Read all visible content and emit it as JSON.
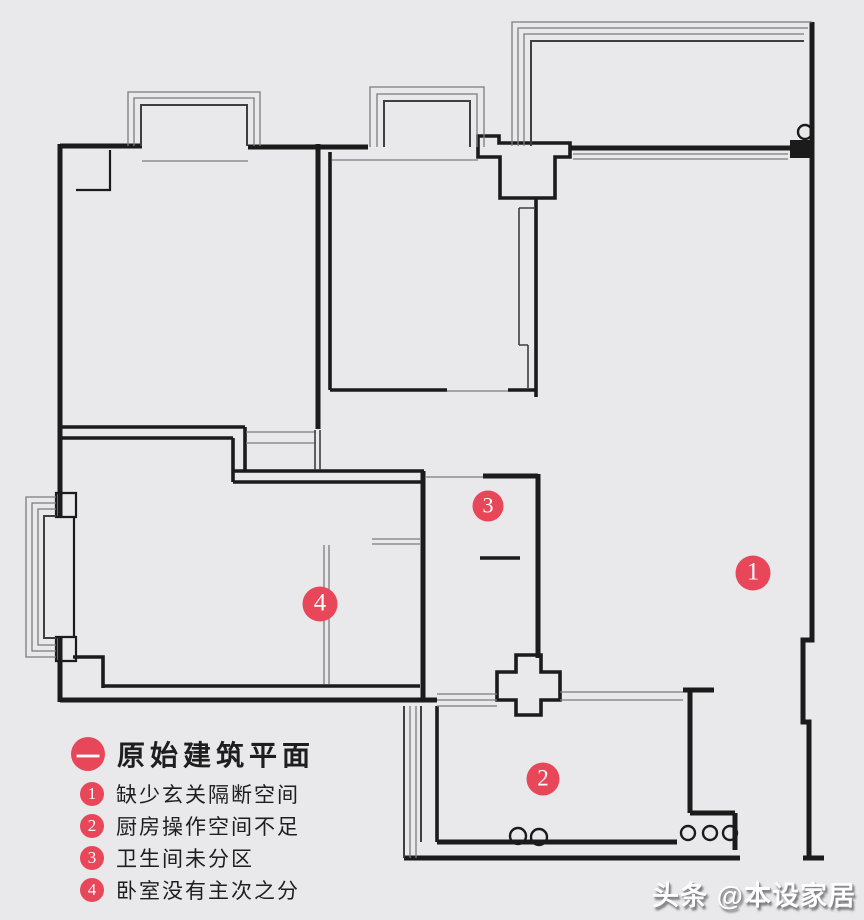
{
  "colors": {
    "background": "#e9e9eb",
    "wall": "#1b1b1b",
    "thin_line": "#7c7c7c",
    "accent_red": "#e8475a",
    "text": "#1e1e1e"
  },
  "legend": {
    "title_marker": "一",
    "title": "原始建筑平面",
    "items": [
      {
        "num": "1",
        "text": "缺少玄关隔断空间"
      },
      {
        "num": "2",
        "text": "厨房操作空间不足"
      },
      {
        "num": "3",
        "text": "卫生间未分区"
      },
      {
        "num": "4",
        "text": "卧室没有主次之分"
      }
    ]
  },
  "plan": {
    "markers": [
      {
        "num": "1",
        "x": 753,
        "y": 573,
        "d": 35
      },
      {
        "num": "2",
        "x": 543,
        "y": 779,
        "d": 33
      },
      {
        "num": "3",
        "x": 488,
        "y": 506,
        "d": 31
      },
      {
        "num": "4",
        "x": 320,
        "y": 604,
        "d": 35
      }
    ]
  },
  "watermark": {
    "text": "头条 @本设家居"
  }
}
